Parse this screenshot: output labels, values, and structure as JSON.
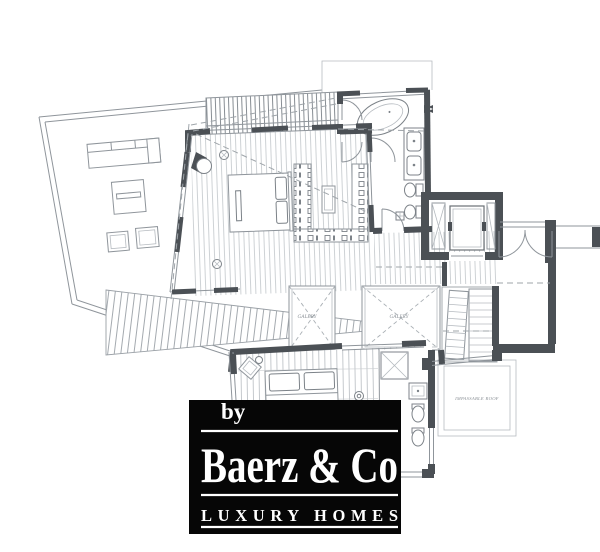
{
  "plan": {
    "labels": {
      "gallery_left": "GALERY",
      "gallery_right": "GALERY",
      "impassable_roof": "IMPASSABLE ROOF"
    },
    "colors": {
      "wall_dark": "#4b5055",
      "line_gray": "#8f959b",
      "line_light": "#c2c7cb",
      "label_gray": "#8a9096",
      "background": "#ffffff"
    }
  },
  "watermark": {
    "byline": "by",
    "brand": "Baerz & Co",
    "tagline": "LUXURY HOMES",
    "background": "#060606",
    "text_color": "#ffffff"
  }
}
